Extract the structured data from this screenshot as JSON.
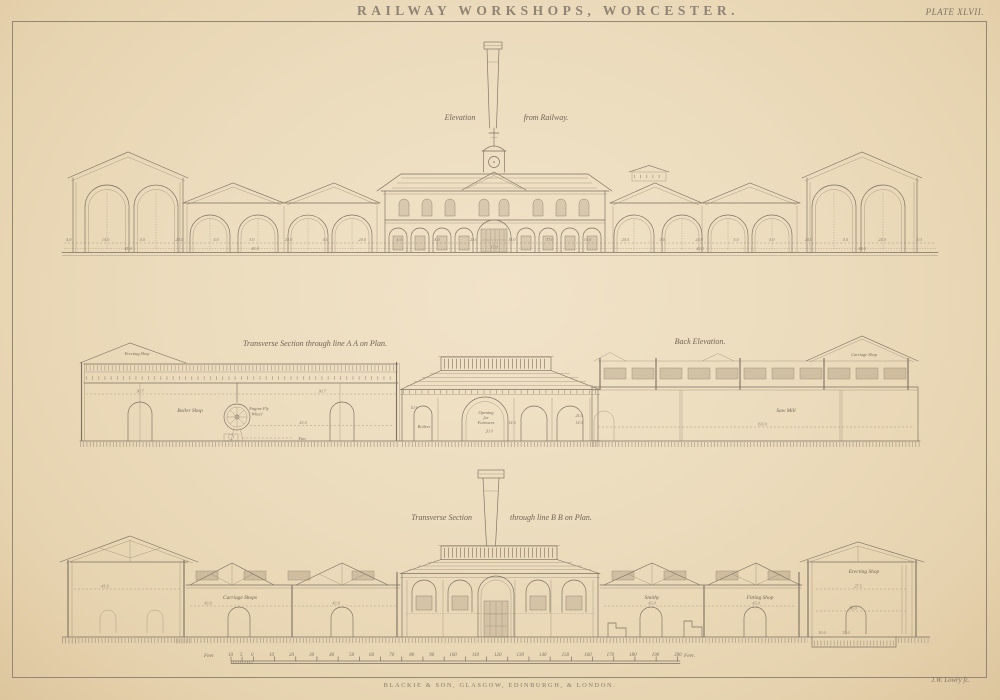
{
  "plate": {
    "title": "RAILWAY WORKSHOPS, WORCESTER.",
    "plate_number": "PLATE XLVII.",
    "publisher": "BLACKIE & SON, GLASGOW, EDINBURGH, & LONDON.",
    "engraver": "J.W. Lowry fc."
  },
  "captions": {
    "elevation_left": "Elevation",
    "elevation_right": "from Railway.",
    "section_aa": "Transverse Section through line A A on Plan.",
    "back_elevation": "Back Elevation.",
    "section_bb_left": "Transverse Section",
    "section_bb_right": "through line B B on Plan."
  },
  "labels": {
    "erecting_shop_mid": "Erecting Shop",
    "boiler_shop": "Boiler Shop",
    "engine_fly_line1": "Engine Fly",
    "engine_fly_line2": "Wheel",
    "fan": "Fan",
    "boilers": "Boilers",
    "furnaces_line1": "Opening",
    "furnaces_line2": "for",
    "furnaces_line3": "Furnaces",
    "saw_mill": "Saw Mill",
    "carriage_shop": "Carriage Shop",
    "carriage_shops": "Carriage Shops",
    "smithy": "Smithy",
    "fitting_shop": "Fitting Shop",
    "erecting_shop_bottom": "Erecting Shop"
  },
  "dims": {
    "d45_4": "45.4",
    "d40_0": "40.0",
    "d44_0": "44.0",
    "d17_0": "17.0",
    "d30_7": "30.7",
    "d43_0": "43.0",
    "d10_6": "10.6",
    "d14_0": "14.0",
    "d20_0": "20.0",
    "d24_0": "24.0",
    "d193_0": "193.0",
    "d41_6": "41.6",
    "d27_5": "27.5",
    "d56_0": "56.0",
    "d33_0": "33.0",
    "d10_0": "10.0"
  },
  "row1_dims": [
    "4.0",
    "14.0",
    "4.0",
    "24.0",
    "4.0",
    "3.0",
    "24.0",
    "4.0",
    "24.0",
    "4.0",
    "14.0",
    "24.0",
    "14.0",
    "37.0",
    "14.0",
    "24.0",
    "4.0",
    "24.0",
    "3.0",
    "5.0",
    "24.0",
    "4.0",
    "24.0",
    "3.0"
  ],
  "scale_bar": {
    "prefix": "Feet",
    "sub_labels": [
      "10",
      "5",
      "0"
    ],
    "tick_labels": [
      "10",
      "20",
      "30",
      "40",
      "50",
      "60",
      "70",
      "80",
      "90",
      "100",
      "110",
      "120",
      "130",
      "140",
      "150",
      "160",
      "170",
      "180",
      "190",
      "200"
    ],
    "suffix": "Feet."
  },
  "ink_color": "#7b7062",
  "paper_color": "#ecdcbd"
}
